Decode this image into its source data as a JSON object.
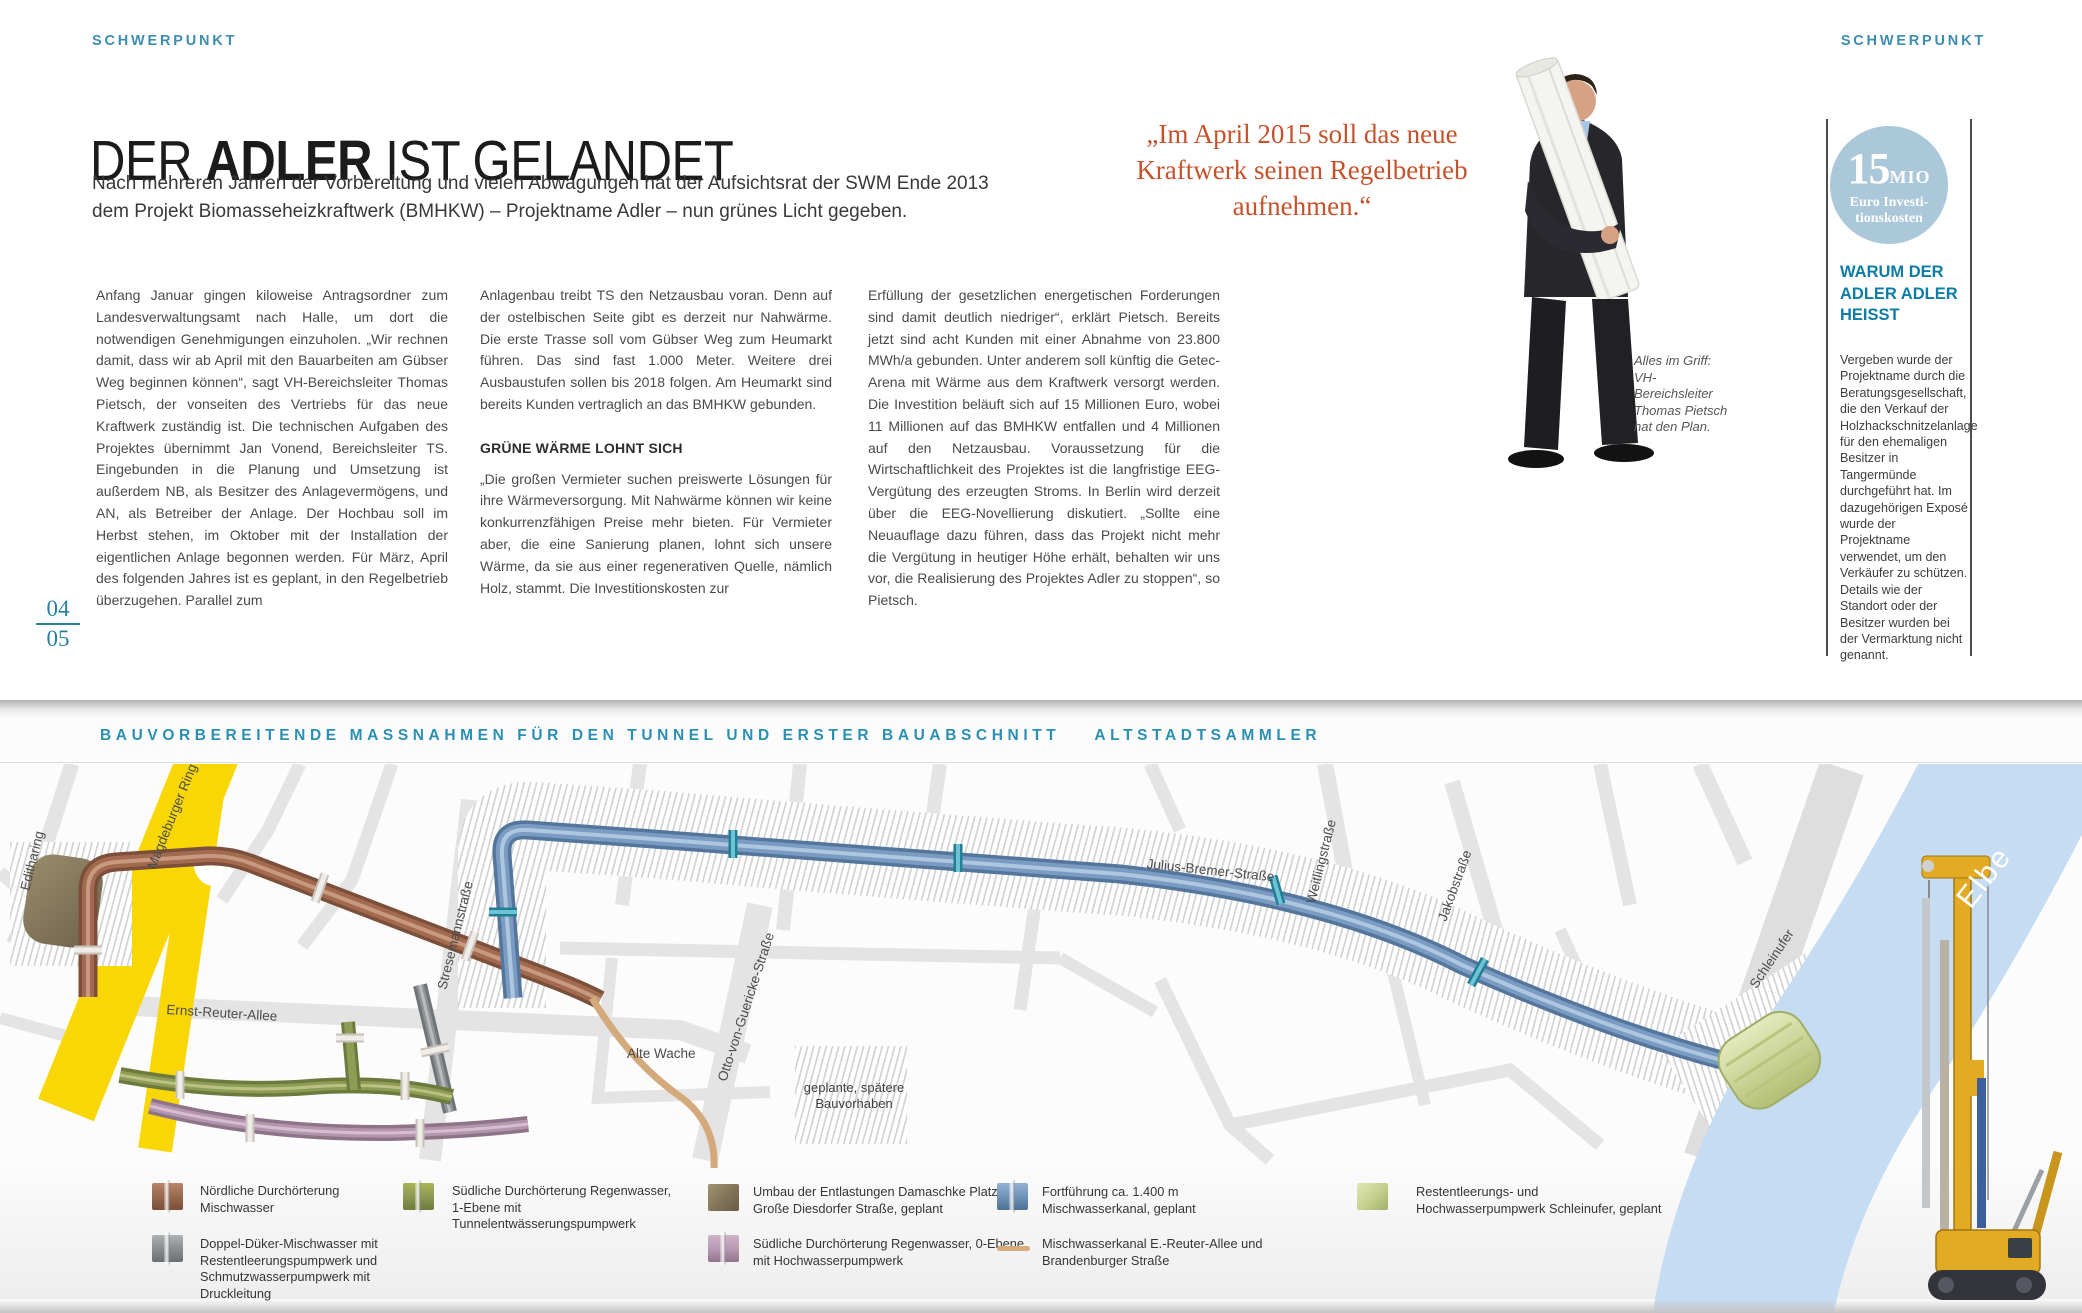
{
  "page": {
    "kicker_left": "SCHWERPUNKT",
    "kicker_right": "SCHWERPUNKT",
    "title": {
      "pre": "DER ",
      "strong": "ADLER",
      "post": " IST GELANDET"
    },
    "intro": "Nach mehreren Jahren der Vorbereitung und vielen Abwägungen hat der Aufsichtsrat der SWM Ende 2013 dem Projekt Biomasseheizkraftwerk (BMHKW) – Projektname Adler – nun grünes Licht gegeben.",
    "body": {
      "col1": "Anfang Januar gingen kiloweise Antragsordner zum Landesverwaltungsamt nach Halle, um dort die notwendigen Genehmigungen einzuholen. „Wir rechnen damit, dass wir ab April mit den Bauarbeiten am Gübser Weg beginnen können“, sagt VH-Bereichsleiter Thomas Pietsch, der vonseiten des Vertriebs für das neue Kraftwerk zuständig ist. Die technischen Aufgaben des Projektes übernimmt Jan Vonend, Bereichsleiter TS. Eingebunden in die Planung und Umsetzung ist außerdem NB, als Besitzer des Anlagevermögens, und AN, als Betreiber der Anlage. Der Hochbau soll im Herbst stehen, im Oktober mit der Installation der eigentlichen Anlage begonnen werden. Für März, April des folgenden Jahres ist es geplant, in den Regelbetrieb überzugehen. Parallel zum",
      "col2_p1": "Anlagenbau treibt TS den Netzausbau voran. Denn auf der ostelbischen Seite gibt es derzeit nur Nahwärme. Die erste Trasse soll vom Gübser Weg zum Heumarkt führen. Das sind fast 1.000 Meter. Weitere drei Ausbaustufen sollen bis 2018 folgen. Am Heumarkt sind bereits Kunden vertraglich an das BMHKW gebunden.",
      "col2_heading": "GRÜNE WÄRME LOHNT SICH",
      "col2_p2": "„Die großen Vermieter suchen preiswerte Lösungen für ihre Wärmeversorgung. Mit Nahwärme können wir keine konkurrenzfähigen Preise mehr bieten. Für Vermieter aber, die eine Sanierung planen, lohnt sich unsere Wärme, da sie aus einer regenerativen Quelle, nämlich Holz, stammt. Die Investitionskosten zur",
      "col3": "Erfüllung der gesetzlichen energetischen Forderungen sind damit deutlich niedriger“, erklärt Pietsch. Bereits jetzt sind acht Kunden mit einer Abnahme von 23.800 MWh/a gebunden. Unter anderem soll künftig die Getec-Arena mit Wärme aus dem Kraftwerk versorgt werden. Die Investition beläuft sich auf 15 Millionen Euro, wobei 11 Millionen auf das BMHKW entfallen und 4 Millionen auf den Netzausbau. Voraussetzung für die Wirtschaftlichkeit des Projektes ist die langfristige EEG-Vergütung des erzeugten Stroms. In Berlin wird derzeit über die EEG-Novellierung diskutiert. „Sollte eine Neuauflage dazu führen, dass das Projekt nicht mehr die Vergütung in heutiger Höhe erhält, behalten wir uns vor, die Realisierung des Projektes Adler zu stoppen“, so Pietsch."
    },
    "quote": "„Im April 2015 soll das neue Kraftwerk seinen Regelbetrieb aufnehmen.“",
    "photo_caption": "Alles im Griff: VH-Bereichsleiter Thomas Pietsch hat den Plan.",
    "page_number_top": "04",
    "page_number_bottom": "05",
    "sidebar": {
      "stat_value": "15",
      "stat_unit": "MIO",
      "stat_caption_line1": "Euro Investi-",
      "stat_caption_line2": "tionskosten",
      "heading": "WARUM DER ADLER ADLER HEISST",
      "body": "Vergeben wurde der Projektname durch die Beratungsgesellschaft, die den Verkauf der Holzhackschnitzelanlage für den ehemaligen Besitzer in Tangermünde durchgeführt hat. Im dazugehörigen Exposé wurde der Projektname verwendet, um den Verkäufer zu schützen. Details wie der Standort oder der Besitzer wurden bei der Vermarktung nicht genannt."
    }
  },
  "map": {
    "title": "BAUVORBEREITENDE MASSNAHMEN FÜR DEN TUNNEL UND ERSTER BAUABSCHNITT",
    "subtitle": "ALTSTADTSAMMLER",
    "labels": {
      "editharing": "Editharing",
      "magdeburger_ring": "Magdeburger Ring",
      "ernst_reuter_allee": "Ernst-Reuter-Allee",
      "stresemannstrasse": "Stresemannstraße",
      "alte_wache": "Alte Wache",
      "otto_von_guericke_strasse": "Otto-von-Guericke-Straße",
      "geplante_bauvorhaben": "geplante, spätere Bauvorhaben",
      "julius_bremer_strasse": "Julius-Bremer-Straße",
      "weitlingstrasse": "Weitlingstraße",
      "jakobstrasse": "Jakobstraße",
      "schleinufer": "Schleinufer",
      "elbe": "Elbe"
    },
    "legend": [
      {
        "label": "Nördliche Durchörterung Mischwasser",
        "color": "#9c6a50"
      },
      {
        "label": "Doppel-Düker-Mischwasser mit Restentleerungspumpwerk und Schmutzwasserpumpwerk mit Druckleitung",
        "color": "#8d9193"
      },
      {
        "label": "Südliche Durchörterung Regenwasser, 1-Ebene mit Tunnelentwässerungspumpwerk",
        "color": "#8d9a54"
      },
      {
        "label": "Umbau der Entlastungen Damaschke Platz und Große Diesdorfer Straße, geplant",
        "color": "#83765a"
      },
      {
        "label": "Südliche Durchörterung Regenwasser, 0-Ebene mit Hochwasserpumpwerk",
        "color": "#b79ab2"
      },
      {
        "label": "Fortführung ca. 1.400 m Mischwasserkanal, geplant",
        "color": "#6f94bb"
      },
      {
        "label": "Mischwasserkanal E.-Reuter-Allee und Brandenburger Straße",
        "color": "#d8ab7a"
      },
      {
        "label": "Restentleerungs- und Hochwasserpumpwerk Schleinufer, geplant",
        "color": "#c3cf8b"
      }
    ]
  },
  "colors": {
    "accent_teal": "#2b8fb4",
    "quote_orange": "#c6522c",
    "stat_circle_blue": "#abc8da",
    "highway_yellow": "#f8d705",
    "river_blue": "#c6dcf2"
  }
}
